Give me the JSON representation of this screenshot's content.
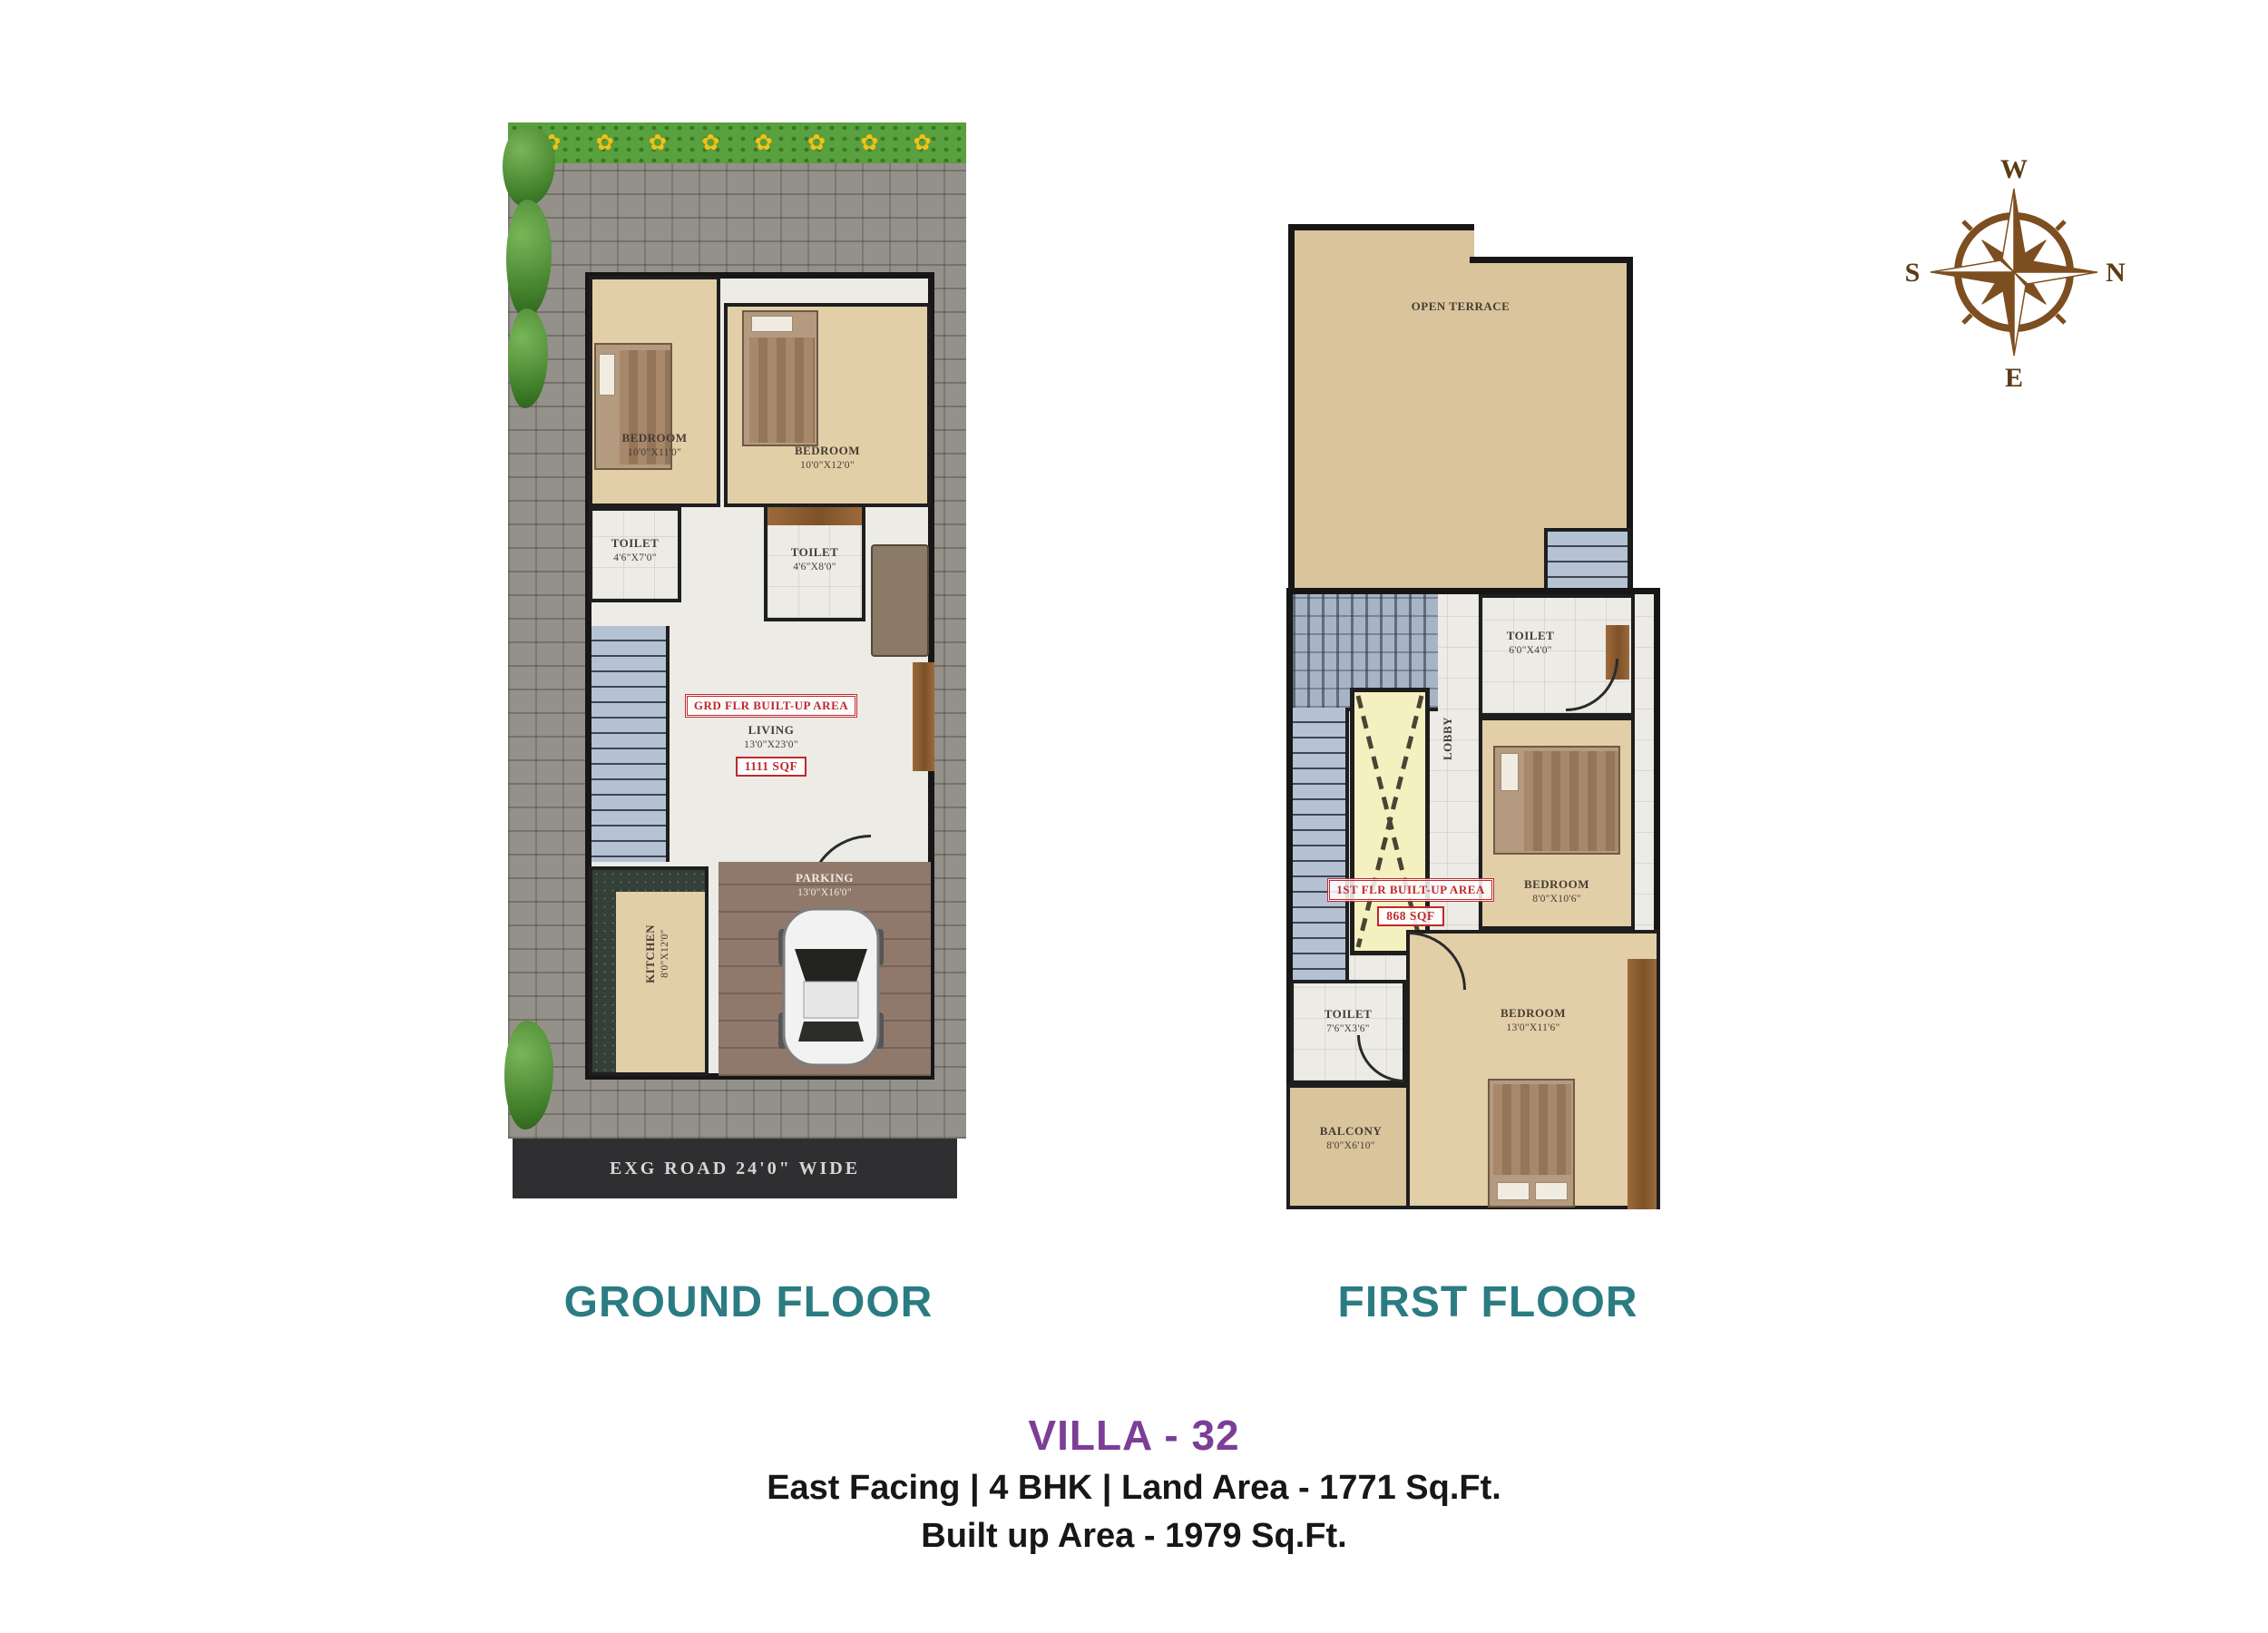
{
  "icons": {
    "flower": "✿"
  },
  "colors": {
    "title_teal": "#2b7c82",
    "villa_purple": "#7c3e97",
    "compass_brown": "#7d4e1f",
    "tag_red": "#c1272d"
  },
  "compass": {
    "w": "W",
    "n": "N",
    "e": "E",
    "s": "S"
  },
  "ground_floor": {
    "title": "GROUND FLOOR",
    "road_label": "EXG ROAD 24'0\" WIDE",
    "area_tag": "GRD FLR BUILT-UP AREA",
    "area_value": "1111 SQF",
    "rooms": {
      "bedroom1": {
        "label": "BEDROOM",
        "dims": "10'0\"X11'0\""
      },
      "bedroom2": {
        "label": "BEDROOM",
        "dims": "10'0\"X12'0\""
      },
      "toilet1": {
        "label": "TOILET",
        "dims": "4'6\"X7'0\""
      },
      "toilet2": {
        "label": "TOILET",
        "dims": "4'6\"X8'0\""
      },
      "living": {
        "label": "LIVING",
        "dims": "13'0\"X23'0\""
      },
      "kitchen": {
        "label": "KITCHEN",
        "dims": "8'0\"X12'0\""
      },
      "parking": {
        "label": "PARKING",
        "dims": "13'0\"X16'0\""
      }
    }
  },
  "first_floor": {
    "title": "FIRST FLOOR",
    "area_tag": "1ST FLR BUILT-UP AREA",
    "area_value": "868 SQF",
    "rooms": {
      "terrace": {
        "label": "OPEN TERRACE"
      },
      "toilet1": {
        "label": "TOILET",
        "dims": "6'0\"X4'0\""
      },
      "bedroom1": {
        "label": "BEDROOM",
        "dims": "8'0\"X10'6\""
      },
      "lobby": {
        "label": "LOBBY"
      },
      "toilet2": {
        "label": "TOILET",
        "dims": "7'6\"X3'6\""
      },
      "balcony": {
        "label": "BALCONY",
        "dims": "8'0\"X6'10\""
      },
      "bedroom2": {
        "label": "BEDROOM",
        "dims": "13'0\"X11'6\""
      }
    }
  },
  "caption": {
    "villa": "VILLA - 32",
    "line1": "East Facing | 4 BHK | Land Area - 1771 Sq.Ft.",
    "line2": "Built up Area - 1979 Sq.Ft."
  }
}
